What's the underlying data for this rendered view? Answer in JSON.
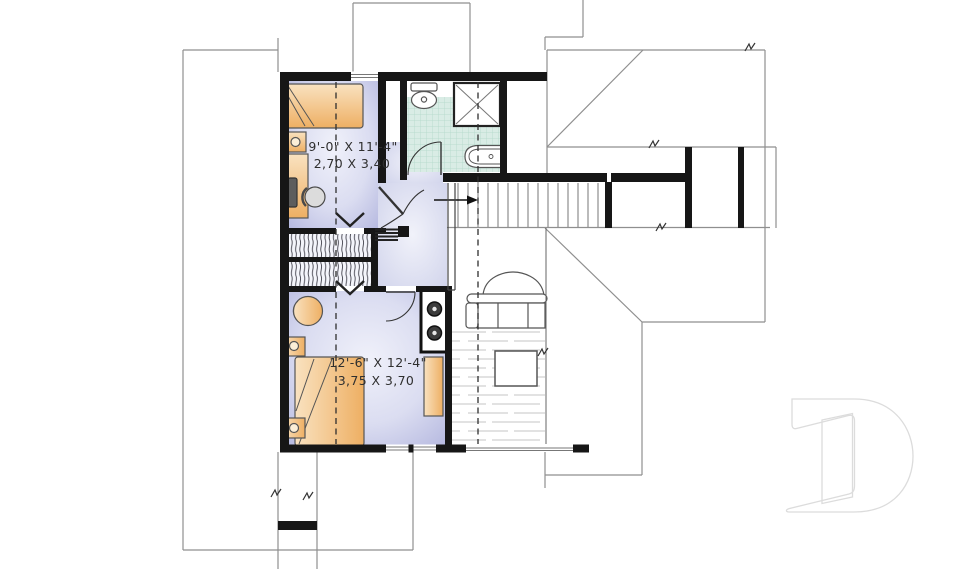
{
  "plan": {
    "type": "second-floor-plan",
    "rooms": {
      "bedroom1": {
        "imperial": "9'-0\" X 11'-4\"",
        "metric": "2,70 X 3,40"
      },
      "bedroom2": {
        "imperial": "12'-6\" X 12'-4\"",
        "metric": "3,75 X 3,70"
      }
    },
    "colors": {
      "wall": "#161616",
      "roofline": "#8f8f8f",
      "bedroom_fill": "#c6c8e8",
      "hall_fill": "#dcdef2",
      "bathroom_tile": "#d9ece5",
      "furniture": "#f2c184",
      "floor_hatch": "#c4c4c4",
      "label_text": "#2f2f2f",
      "watermark_outline": "#dcdcdc"
    },
    "symbols": {
      "stair_arrow": "up-direction-arrow",
      "section_lines": "dashed-vertical-cut-lines",
      "watermark": "builder-logo-letter-d"
    }
  }
}
